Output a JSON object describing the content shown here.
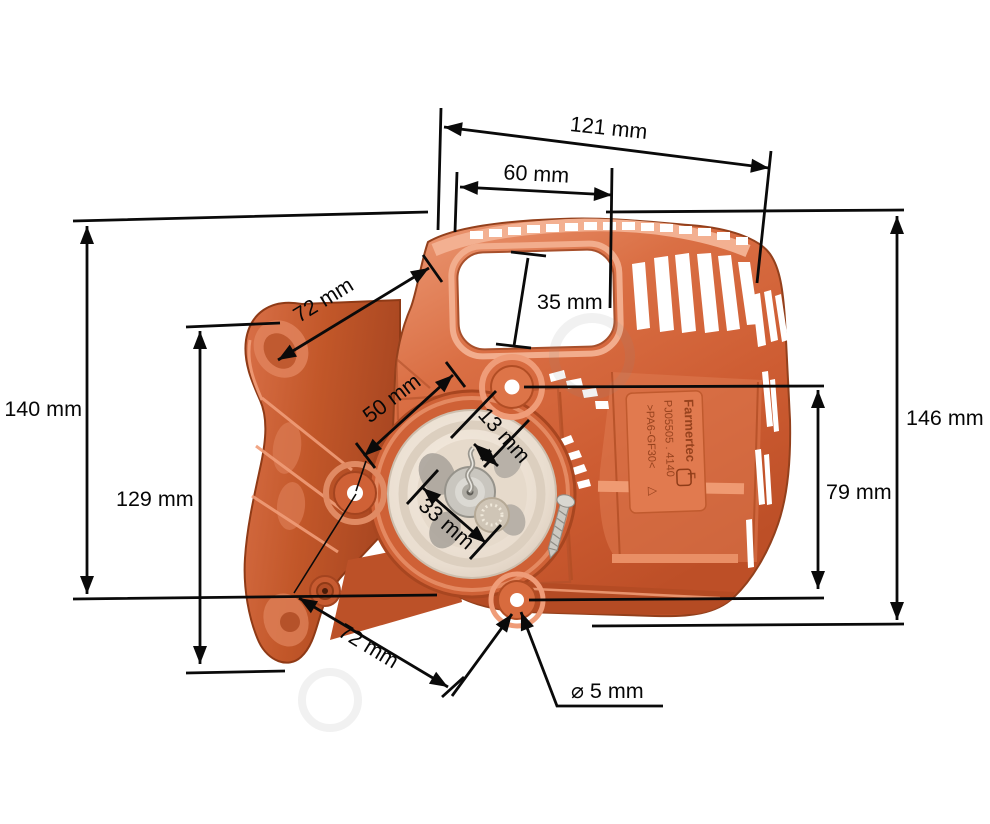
{
  "colors": {
    "background": "#ffffff",
    "part_orange": "#d96b41",
    "part_orange_dark": "#b84f27",
    "pulley_cream": "#ece1d3",
    "annotation": "#0a0a0a"
  },
  "molded_text": {
    "logo": "F",
    "brand": "Farmertec",
    "part_number": "PJ05505 . 4140",
    "material": ">PA6-GF30<",
    "recycle_symbol": "△"
  },
  "dimensions": {
    "top_width": {
      "label": "121 mm",
      "value_mm": 121
    },
    "handle_width": {
      "label": "60 mm",
      "value_mm": 60
    },
    "opening_height": {
      "label": "35 mm",
      "value_mm": 35
    },
    "upper_hole_span": {
      "label": "72 mm",
      "value_mm": 72
    },
    "total_height_left": {
      "label": "140 mm",
      "value_mm": 140
    },
    "bracket_height": {
      "label": "129 mm",
      "value_mm": 129
    },
    "center_hole_span": {
      "label": "50 mm",
      "value_mm": 50
    },
    "pawl_span": {
      "label": "13 mm",
      "value_mm": 13
    },
    "hub_span": {
      "label": "33 mm",
      "value_mm": 33
    },
    "total_height_right": {
      "label": "146 mm",
      "value_mm": 146
    },
    "right_hole_span": {
      "label": "79 mm",
      "value_mm": 79
    },
    "lower_hole_span": {
      "label": "72 mm",
      "value_mm": 72
    },
    "hole_diameter": {
      "label": "⌀ 5 mm",
      "value_mm": 5
    }
  }
}
